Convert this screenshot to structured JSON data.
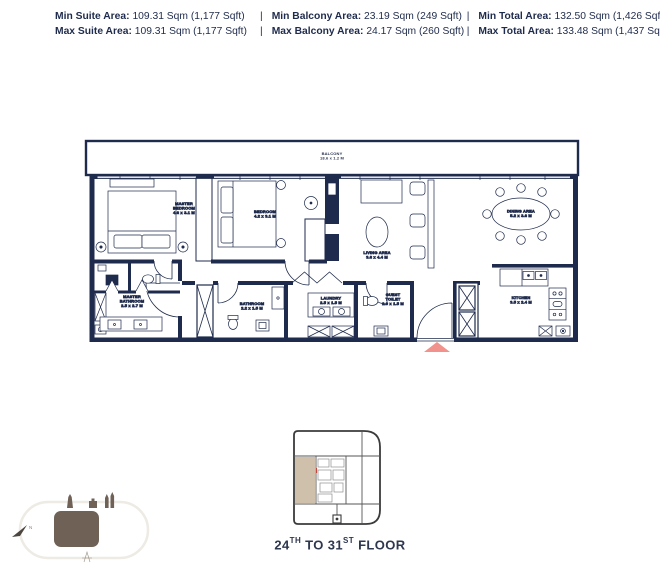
{
  "colors": {
    "navy": "#1f2b4c",
    "salmon": "#f2928c",
    "tan": "#cfc0ab",
    "brown": "#6f6156",
    "keyline": "#3b3b3b",
    "lightline": "#eeeae4"
  },
  "header": {
    "divider": "|",
    "rows": [
      {
        "cells": [
          {
            "label": "Min Suite Area:",
            "value": "109.31 Sqm (1,177 Sqft)"
          },
          {
            "label": "Min Balcony Area:",
            "value": "23.19 Sqm (249 Sqft)"
          },
          {
            "label": "Min Total Area:",
            "value": "132.50 Sqm (1,426 Sqft)"
          }
        ]
      },
      {
        "cells": [
          {
            "label": "Max Suite Area:",
            "value": "109.31 Sqm (1,177 Sqft)"
          },
          {
            "label": "Max Balcony Area:",
            "value": "24.17 Sqm (260 Sqft)"
          },
          {
            "label": "Max Total Area:",
            "value": "133.48 Sqm (1,437 Sqft)"
          }
        ]
      }
    ]
  },
  "floorplan": {
    "rooms": {
      "balcony": {
        "name": "BALCONY",
        "dims": "18.6 x 1.2 M"
      },
      "master_bedroom": {
        "name": "MASTER BEDROOM",
        "dims": "4.6 x 3.1 M"
      },
      "bedroom": {
        "name": "BEDROOM",
        "dims": "4.2 x 3.1 M"
      },
      "living_area": {
        "name": "LIVING AREA",
        "dims": "3.6 x 4.4 M"
      },
      "dining_area": {
        "name": "DINING AREA",
        "dims": "5.2 x 3.6 M"
      },
      "master_bathroom": {
        "name": "MASTER BATHROOM",
        "dims": "2.5 x 2.7 M"
      },
      "bathroom": {
        "name": "BATHROOM",
        "dims": "2.2 x 1.5 M"
      },
      "laundry": {
        "name": "LAUNDRY",
        "dims": "2.5 x 1.5 M"
      },
      "guest_toilet": {
        "name": "GUEST TOILET",
        "dims": "2.0 x 1.5 M"
      },
      "kitchen": {
        "name": "KITCHEN",
        "dims": "3.5 x 2.4 M"
      }
    }
  },
  "keyplan": {
    "floor_label": {
      "from": "24",
      "from_sup": "TH",
      "mid": " TO ",
      "to": "31",
      "to_sup": "ST",
      "end": " FLOOR"
    }
  }
}
